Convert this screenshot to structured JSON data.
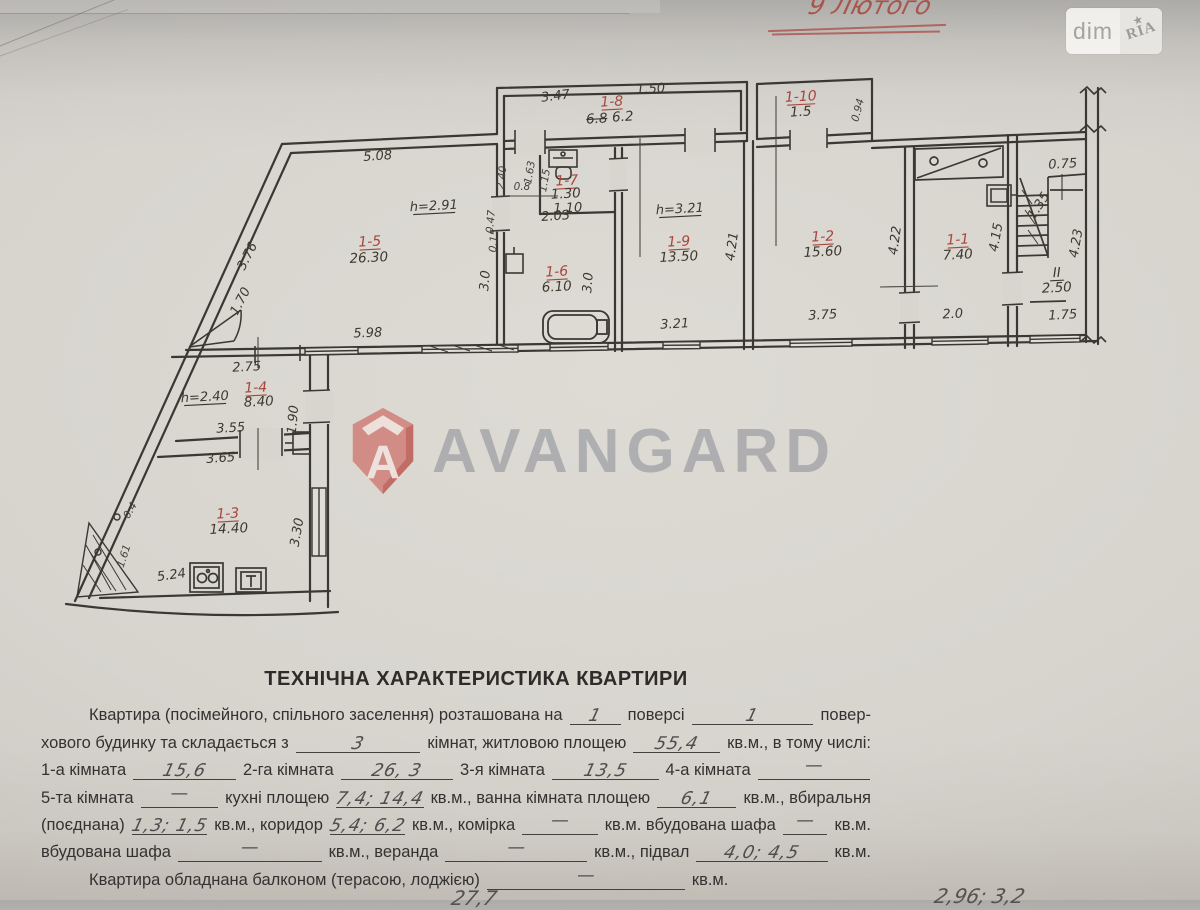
{
  "colors": {
    "paper": "#d8d5cf",
    "paper_dark": "#b3b1ae",
    "ink": "#39362f",
    "red_pen": "#a8453c",
    "watermark_red": "#cf6f68",
    "watermark_gray": "#80848e",
    "handwriting": "#4f4d4f"
  },
  "header": {
    "red_note": "9 Лютого",
    "logo_left": "dim",
    "logo_right": "RIA",
    "logo_star": "★"
  },
  "watermark": {
    "brand": "AVANGARD",
    "shield_letter": "A"
  },
  "plan": {
    "fixtures": [
      "bathtub",
      "toilet",
      "stove",
      "kitchen-sink",
      "cupboard",
      "wash-sink",
      "staircase",
      "door-swing"
    ],
    "labels": [
      {
        "t": "5.08",
        "x": 378,
        "y": 160,
        "r": -4,
        "c": "dim"
      },
      {
        "t": "h=2.91",
        "x": 434,
        "y": 210,
        "r": -3,
        "c": "dim",
        "ul": 1
      },
      {
        "t": "1-5",
        "x": 370,
        "y": 246,
        "r": -3,
        "c": "room",
        "ul": 1
      },
      {
        "t": "26.30",
        "x": 369,
        "y": 262,
        "r": -3,
        "c": "area"
      },
      {
        "t": "5.98",
        "x": 368,
        "y": 337,
        "r": -2,
        "c": "dim"
      },
      {
        "t": "3.76",
        "x": 251,
        "y": 258,
        "r": -63,
        "c": "dim"
      },
      {
        "t": "1.70",
        "x": 244,
        "y": 303,
        "r": -63,
        "c": "dim"
      },
      {
        "t": "2.75",
        "x": 247,
        "y": 371,
        "r": -3,
        "c": "dim"
      },
      {
        "t": "h=2.40",
        "x": 205,
        "y": 401,
        "r": -3,
        "c": "dim",
        "ul": 1
      },
      {
        "t": "1-4",
        "x": 256,
        "y": 392,
        "r": -3,
        "c": "room",
        "ul": 1
      },
      {
        "t": "8.40",
        "x": 259,
        "y": 406,
        "r": -3,
        "c": "area"
      },
      {
        "t": "3.55",
        "x": 231,
        "y": 432,
        "r": -3,
        "c": "dim"
      },
      {
        "t": "1.90",
        "x": 297,
        "y": 420,
        "r": -85,
        "c": "dim"
      },
      {
        "t": "3.65",
        "x": 221,
        "y": 462,
        "r": -4,
        "c": "dim"
      },
      {
        "t": "1-3",
        "x": 228,
        "y": 518,
        "r": -3,
        "c": "room",
        "ul": 1
      },
      {
        "t": "14.40",
        "x": 229,
        "y": 533,
        "r": -3,
        "c": "area"
      },
      {
        "t": "3.30",
        "x": 301,
        "y": 533,
        "r": -80,
        "c": "dim"
      },
      {
        "t": "5.24",
        "x": 172,
        "y": 579,
        "r": -8,
        "c": "dim"
      },
      {
        "t": "0.4",
        "x": 133,
        "y": 512,
        "r": -60,
        "c": "dimS"
      },
      {
        "t": "1.61",
        "x": 127,
        "y": 557,
        "r": -72,
        "c": "dimS"
      },
      {
        "t": "2.40",
        "x": 505,
        "y": 178,
        "r": -83,
        "c": "dimS"
      },
      {
        "t": "1.63",
        "x": 533,
        "y": 173,
        "r": -80,
        "c": "dimS"
      },
      {
        "t": "1.15",
        "x": 548,
        "y": 181,
        "r": -80,
        "c": "dimS"
      },
      {
        "t": "1-7",
        "x": 567,
        "y": 185,
        "r": -3,
        "c": "room",
        "ul": 1
      },
      {
        "t": "1.30",
        "x": 566,
        "y": 198,
        "r": -3,
        "c": "area"
      },
      {
        "t": "1.10",
        "x": 568,
        "y": 212,
        "r": -2,
        "c": "dim"
      },
      {
        "t": "0.8",
        "x": 522,
        "y": 190,
        "r": 0,
        "c": "dimS"
      },
      {
        "t": "0.47",
        "x": 494,
        "y": 222,
        "r": -85,
        "c": "dimS"
      },
      {
        "t": "0.15",
        "x": 497,
        "y": 241,
        "r": -85,
        "c": "dimS"
      },
      {
        "t": "2.03",
        "x": 556,
        "y": 220,
        "r": -4,
        "c": "dim"
      },
      {
        "t": "1-6",
        "x": 557,
        "y": 276,
        "r": -3,
        "c": "room",
        "ul": 1
      },
      {
        "t": "6.10",
        "x": 557,
        "y": 291,
        "r": -3,
        "c": "area"
      },
      {
        "t": "3.0",
        "x": 489,
        "y": 281,
        "r": -85,
        "c": "dim"
      },
      {
        "t": "3.0",
        "x": 592,
        "y": 283,
        "r": -85,
        "c": "dim"
      },
      {
        "t": "3.47",
        "x": 556,
        "y": 100,
        "r": -7,
        "c": "dim"
      },
      {
        "t": "1.50",
        "x": 651,
        "y": 93,
        "r": -4,
        "c": "dim"
      },
      {
        "t": "1-8",
        "x": 612,
        "y": 106,
        "r": -3,
        "c": "room",
        "ul": 1
      },
      {
        "t": "6.8",
        "x": 597,
        "y": 123,
        "r": -3,
        "c": "area",
        "strike": 1
      },
      {
        "t": "6.2",
        "x": 623,
        "y": 121,
        "r": -3,
        "c": "area"
      },
      {
        "t": "h=3.21",
        "x": 680,
        "y": 213,
        "r": -3,
        "c": "dim",
        "ul": 1
      },
      {
        "t": "1-9",
        "x": 679,
        "y": 246,
        "r": -3,
        "c": "room",
        "ul": 1
      },
      {
        "t": "13.50",
        "x": 679,
        "y": 261,
        "r": -3,
        "c": "area"
      },
      {
        "t": "3.21",
        "x": 675,
        "y": 328,
        "r": -3,
        "c": "dim"
      },
      {
        "t": "4.21",
        "x": 736,
        "y": 247,
        "r": -82,
        "c": "dim"
      },
      {
        "t": "1-10",
        "x": 801,
        "y": 101,
        "r": -3,
        "c": "room",
        "ul": 1
      },
      {
        "t": "1.5",
        "x": 801,
        "y": 116,
        "r": -3,
        "c": "area"
      },
      {
        "t": "0.94",
        "x": 861,
        "y": 111,
        "r": -75,
        "c": "dimS"
      },
      {
        "t": "1-2",
        "x": 823,
        "y": 241,
        "r": -3,
        "c": "room",
        "ul": 1
      },
      {
        "t": "15.60",
        "x": 823,
        "y": 256,
        "r": -3,
        "c": "area"
      },
      {
        "t": "3.75",
        "x": 823,
        "y": 319,
        "r": -3,
        "c": "dim"
      },
      {
        "t": "4.22",
        "x": 899,
        "y": 241,
        "r": -82,
        "c": "dim"
      },
      {
        "t": "1-1",
        "x": 958,
        "y": 244,
        "r": -3,
        "c": "room",
        "ul": 1
      },
      {
        "t": "7.40",
        "x": 958,
        "y": 259,
        "r": -3,
        "c": "area"
      },
      {
        "t": "2.0",
        "x": 953,
        "y": 318,
        "r": -3,
        "c": "dim"
      },
      {
        "t": "4.15",
        "x": 1000,
        "y": 238,
        "r": -80,
        "c": "dim"
      },
      {
        "t": "0.75",
        "x": 1063,
        "y": 168,
        "r": -3,
        "c": "dim"
      },
      {
        "t": "1.35",
        "x": 1042,
        "y": 208,
        "r": -57,
        "c": "dim"
      },
      {
        "t": "4.23",
        "x": 1080,
        "y": 244,
        "r": -80,
        "c": "dim"
      },
      {
        "t": "II",
        "x": 1057,
        "y": 277,
        "r": -3,
        "c": "area",
        "ul": 1
      },
      {
        "t": "2.50",
        "x": 1057,
        "y": 292,
        "r": -3,
        "c": "area"
      },
      {
        "t": "1.75",
        "x": 1063,
        "y": 319,
        "r": -3,
        "c": "dim"
      }
    ]
  },
  "form": {
    "title": "ТЕХНІЧНА ХАРАКТЕРИСТИКА КВАРТИРИ",
    "lines": [
      {
        "indent": true,
        "parts": [
          {
            "t": "Квартира (посімейного, спільного заселення) розташована на"
          },
          {
            "hw": "1",
            "w": 62
          },
          {
            "t": "поверсі"
          },
          {
            "hw": "1",
            "w": 148
          },
          {
            "t": "повер-"
          }
        ]
      },
      {
        "parts": [
          {
            "t": "хового будинку та складається з"
          },
          {
            "hw": "3",
            "w": 138
          },
          {
            "t": "кімнат, житловою площею"
          },
          {
            "hw": "55,4",
            "w": 96
          },
          {
            "t": "кв.м., в тому числі:"
          }
        ]
      },
      {
        "parts": [
          {
            "t": "1-а кімната"
          },
          {
            "hw": "15,6",
            "w": 108
          },
          {
            "t": "2-га кімната"
          },
          {
            "hw": "26, 3",
            "w": 118
          },
          {
            "t": "3-я кімната"
          },
          {
            "hw": "13,5",
            "w": 112
          },
          {
            "t": "4-а кімната"
          },
          {
            "hw": "—",
            "w": 118
          }
        ]
      },
      {
        "parts": [
          {
            "t": "5-та кімната"
          },
          {
            "hw": "—",
            "w": 92
          },
          {
            "t": "кухні площею"
          },
          {
            "hw": "7,4; 14,4",
            "w": 100
          },
          {
            "t": "кв.м., ванна кімната площею"
          },
          {
            "hw": "6,1",
            "w": 94
          },
          {
            "t": "кв.м., вбиральня"
          }
        ]
      },
      {
        "parts": [
          {
            "t": "(поєднана)"
          },
          {
            "hw": "1,3; 1,5",
            "w": 88
          },
          {
            "t": "кв.м., коридор"
          },
          {
            "hw": "5,4; 6,2",
            "w": 86
          },
          {
            "t": "кв.м., комірка"
          },
          {
            "hw": "—",
            "w": 88
          },
          {
            "t": "кв.м. вбудована шафа"
          },
          {
            "hw": "—",
            "w": 52
          },
          {
            "t": "кв.м."
          }
        ]
      },
      {
        "parts": [
          {
            "t": "вбудована шафа"
          },
          {
            "hw": "—",
            "w": 160
          },
          {
            "t": "кв.м., веранда"
          },
          {
            "hw": "—",
            "w": 158
          },
          {
            "t": "кв.м., підвал"
          },
          {
            "hw": "4,0; 4,5",
            "w": 146
          },
          {
            "t": "кв.м."
          }
        ]
      },
      {
        "indent": true,
        "parts": [
          {
            "t": "Квартира обладнана балконом (терасою, лоджією)"
          },
          {
            "hw": "—",
            "w": 198
          },
          {
            "t": "кв.м."
          }
        ]
      }
    ],
    "cutoff_left": "27,7",
    "cutoff_right": "2,96; 3,2"
  }
}
